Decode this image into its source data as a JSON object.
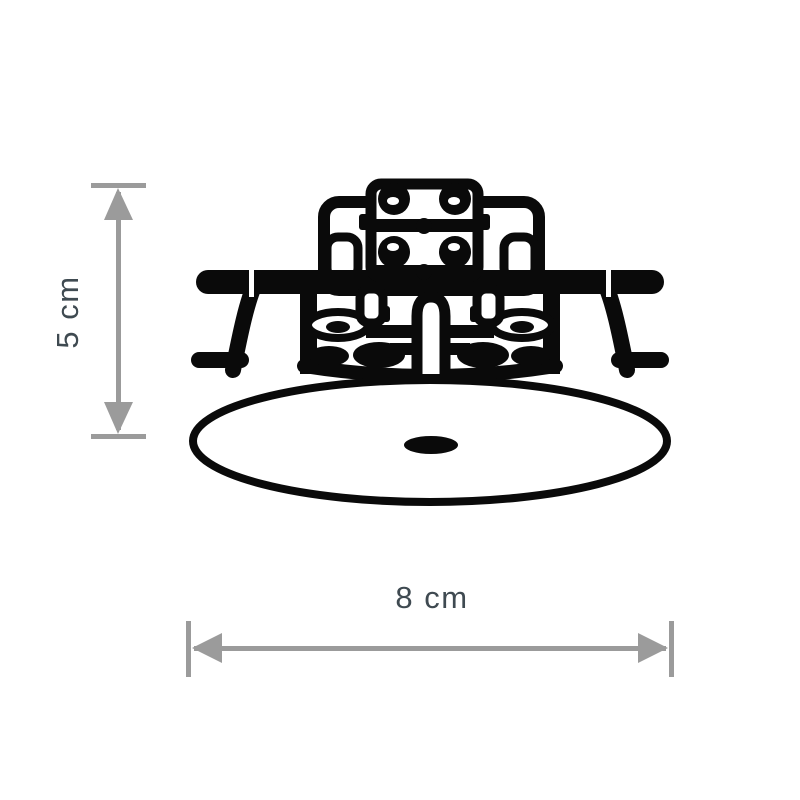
{
  "page": {
    "background": "#ffffff",
    "kind": "product-dimension-diagram"
  },
  "diagram": {
    "subject": "recessed-ceiling-downlight-line-drawing",
    "description": "Black outline technical drawing of a recessed ceiling spotlight: elliptical trim plate with small center hole, lower housing with cable clamps, terminal block on top and spring mounting clips on both sides",
    "colors": {
      "line": "#0a0a0a",
      "dimension": "#9b9b9b",
      "label": "#3f4a51",
      "background": "#ffffff"
    },
    "dimensions": {
      "height": {
        "label": "5 cm",
        "orientation": "vertical"
      },
      "width": {
        "label": "8 cm",
        "orientation": "horizontal"
      }
    }
  }
}
